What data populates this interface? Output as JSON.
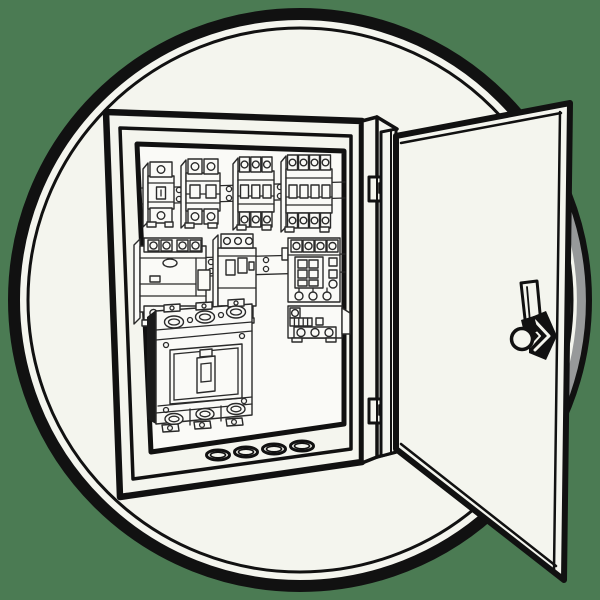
{
  "illustration": {
    "name": "open-electrical-enclosure",
    "style": "black-and-white line art inside a circular badge on a green background",
    "subject": "wall-mounted electrical distribution board with its door open to the right",
    "components": [
      {
        "name": "circle-badge"
      },
      {
        "name": "enclosure-box"
      },
      {
        "name": "panel-interior-backplate"
      },
      {
        "name": "din-rail-top"
      },
      {
        "name": "breaker-1-pole",
        "poles": 1
      },
      {
        "name": "breaker-2-pole",
        "poles": 2
      },
      {
        "name": "breaker-3-pole",
        "poles": 3
      },
      {
        "name": "breaker-4-pole",
        "poles": 4
      },
      {
        "name": "din-rail-middle"
      },
      {
        "name": "rcd-breaker"
      },
      {
        "name": "motor-protection-breaker"
      },
      {
        "name": "contactor"
      },
      {
        "name": "overload-relay"
      },
      {
        "name": "mccb-molded-case-breaker"
      },
      {
        "name": "knockout-holes",
        "count": 4
      },
      {
        "name": "door-hinge-top"
      },
      {
        "name": "door-hinge-bottom"
      },
      {
        "name": "door-panel"
      },
      {
        "name": "door-handle-latch"
      }
    ]
  },
  "colors": {
    "background": "#4b7b53",
    "ink": "#111111",
    "paper": "#f4f5ee",
    "panel_interior": "#fafaf7",
    "shadow_gray": "#97999a",
    "component_ink": "#2a2a2a",
    "mccb_dark": "#1b1b1b"
  }
}
